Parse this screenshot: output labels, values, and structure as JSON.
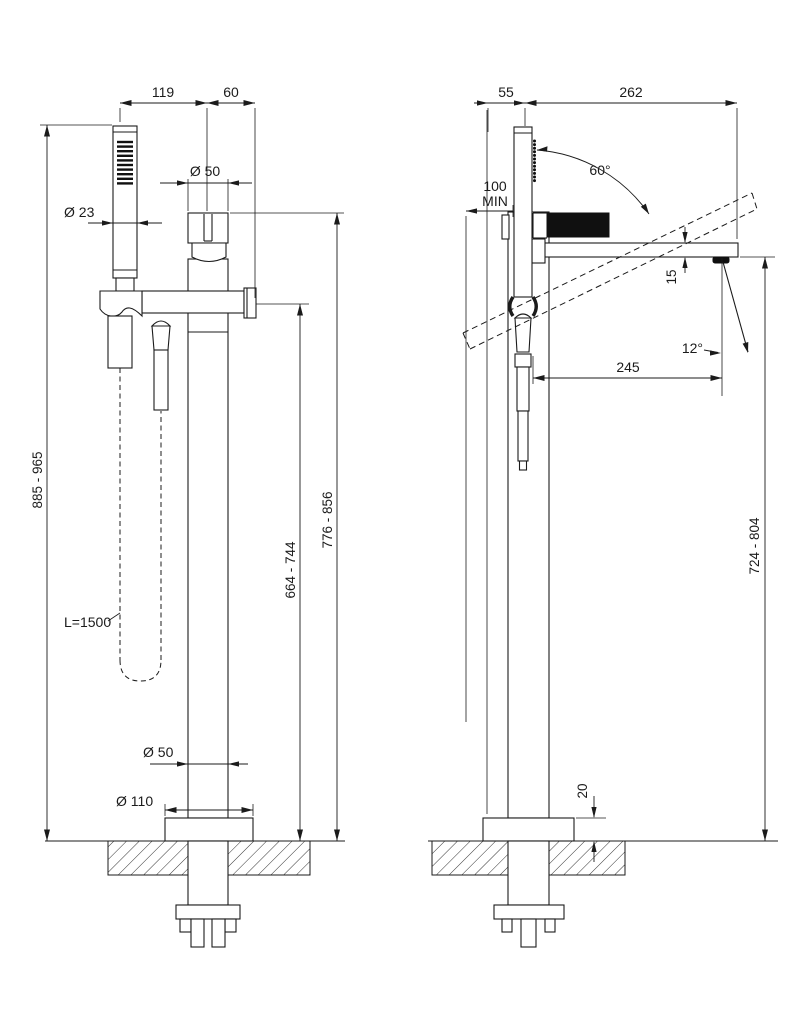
{
  "page": {
    "background": "#ffffff",
    "line_color": "#1b1b1b"
  },
  "front_view": {
    "name": "front view",
    "dims": {
      "handshower_offset": "119",
      "spout_offset": "60",
      "handle_diameter": "Ø 50",
      "handshower_diameter": "Ø 23",
      "overall_height": "885 - 965",
      "spout_outlet_height": "664 - 744",
      "handle_top_height": "776 - 856",
      "hose_length": "L=1500",
      "column_diameter": "Ø 50",
      "base_plate_diameter": "Ø 110"
    }
  },
  "side_view": {
    "name": "side view",
    "dims": {
      "handshower_depth_offset": "55",
      "spout_reach": "262",
      "min_clearance_value": "100",
      "min_clearance_suffix": "MIN",
      "handshower_swivel_angle": "60°",
      "spout_thickness": "15",
      "stream_angle": "12°",
      "stream_horizontal_reach": "245",
      "spout_underside_height": "724 - 804",
      "base_plate_height": "20"
    }
  }
}
